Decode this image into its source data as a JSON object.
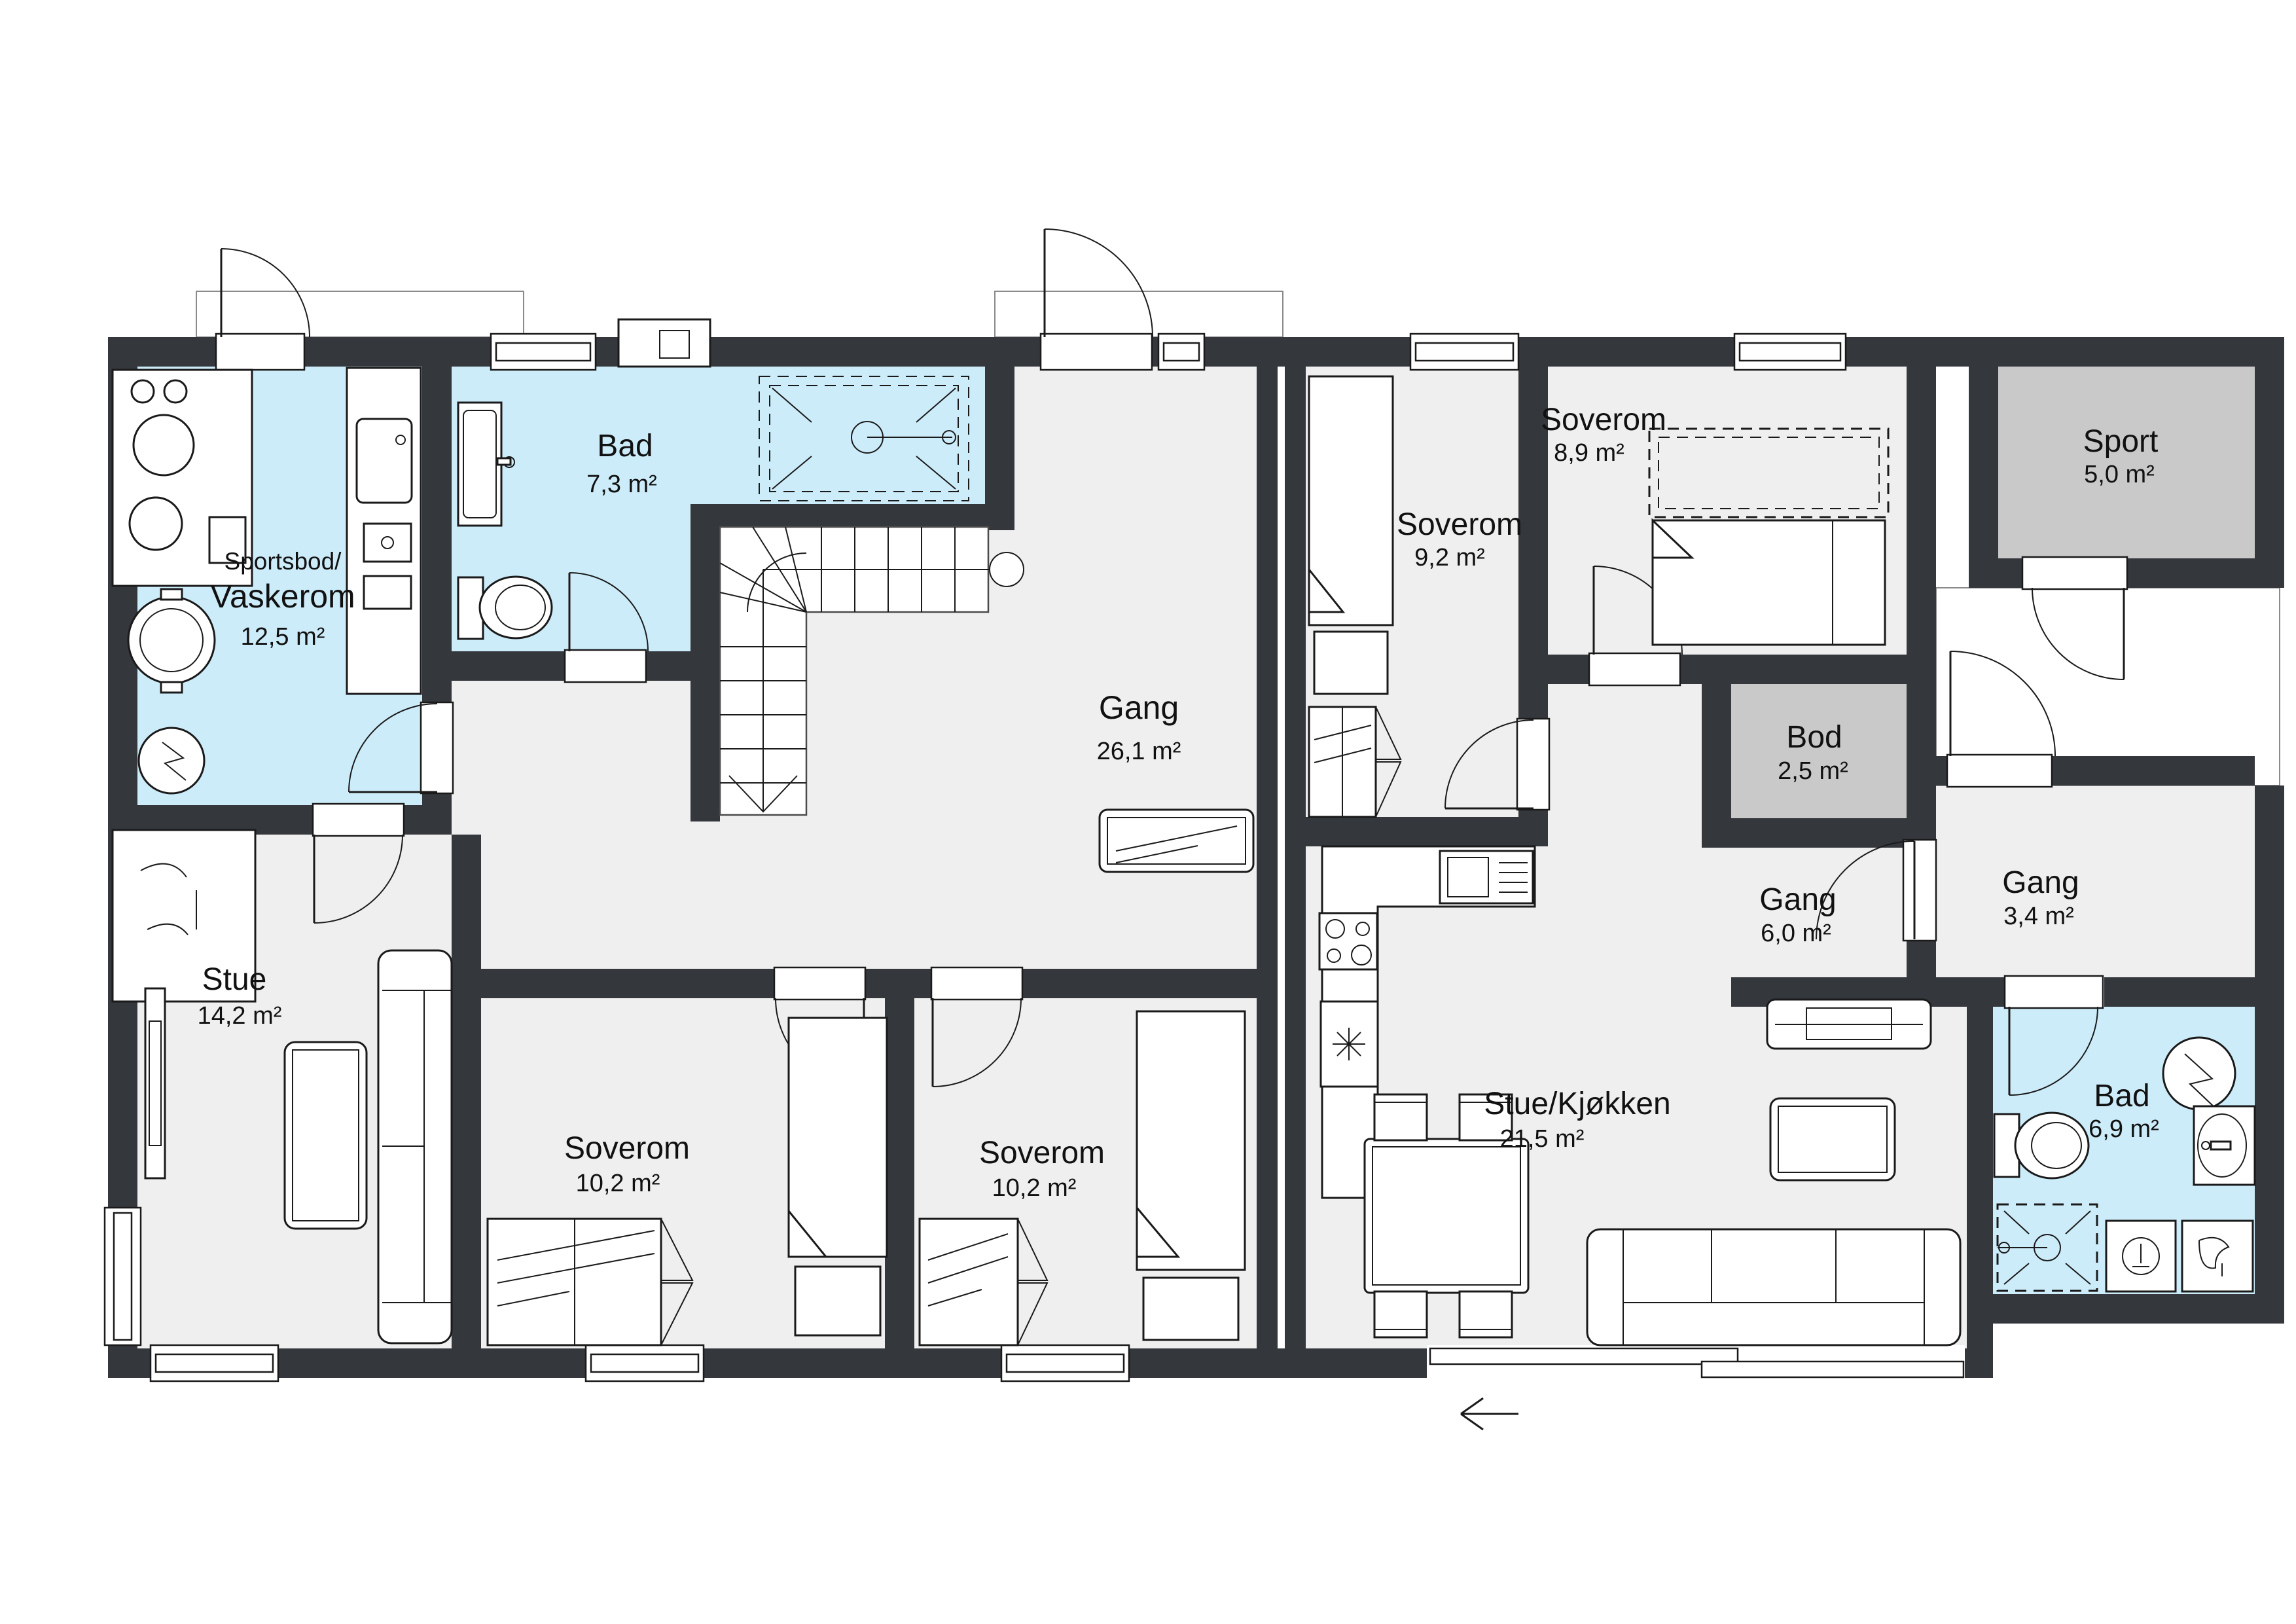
{
  "plan": {
    "type": "floor-plan",
    "language": "Norwegian",
    "colors": {
      "wall": "#34373c",
      "room_standard": "#efefef",
      "room_wet": "#cdecf9",
      "room_storage": "#c9c9c9",
      "background": "#ffffff",
      "line": "#1a1a1a"
    },
    "entry_arrow": "←"
  },
  "rooms": [
    {
      "id": "sportsbod-vaskerom",
      "name_line1": "Sportsbod/",
      "name": "Vaskerom",
      "area": "12,5 m²",
      "type": "wet"
    },
    {
      "id": "bad-7-3",
      "name": "Bad",
      "area": "7,3 m²",
      "type": "wet"
    },
    {
      "id": "gang-26-1",
      "name": "Gang",
      "area": "26,1 m²",
      "type": "standard"
    },
    {
      "id": "stue",
      "name": "Stue",
      "area": "14,2 m²",
      "type": "standard"
    },
    {
      "id": "soverom-10-2-a",
      "name": "Soverom",
      "area": "10,2 m²",
      "type": "standard"
    },
    {
      "id": "soverom-10-2-b",
      "name": "Soverom",
      "area": "10,2 m²",
      "type": "standard"
    },
    {
      "id": "soverom-9-2",
      "name": "Soverom",
      "area": "9,2 m²",
      "type": "standard"
    },
    {
      "id": "soverom-8-9",
      "name": "Soverom",
      "area": "8,9 m²",
      "type": "standard"
    },
    {
      "id": "sport",
      "name": "Sport",
      "area": "5,0 m²",
      "type": "storage"
    },
    {
      "id": "bod",
      "name": "Bod",
      "area": "2,5 m²",
      "type": "storage"
    },
    {
      "id": "gang-6-0",
      "name": "Gang",
      "area": "6,0 m²",
      "type": "standard"
    },
    {
      "id": "gang-3-4",
      "name": "Gang",
      "area": "3,4 m²",
      "type": "standard"
    },
    {
      "id": "stue-kjokken",
      "name": "Stue/Kjøkken",
      "area": "21,5 m²",
      "type": "standard"
    },
    {
      "id": "bad-6-9",
      "name": "Bad",
      "area": "6,9 m²",
      "type": "wet"
    }
  ]
}
